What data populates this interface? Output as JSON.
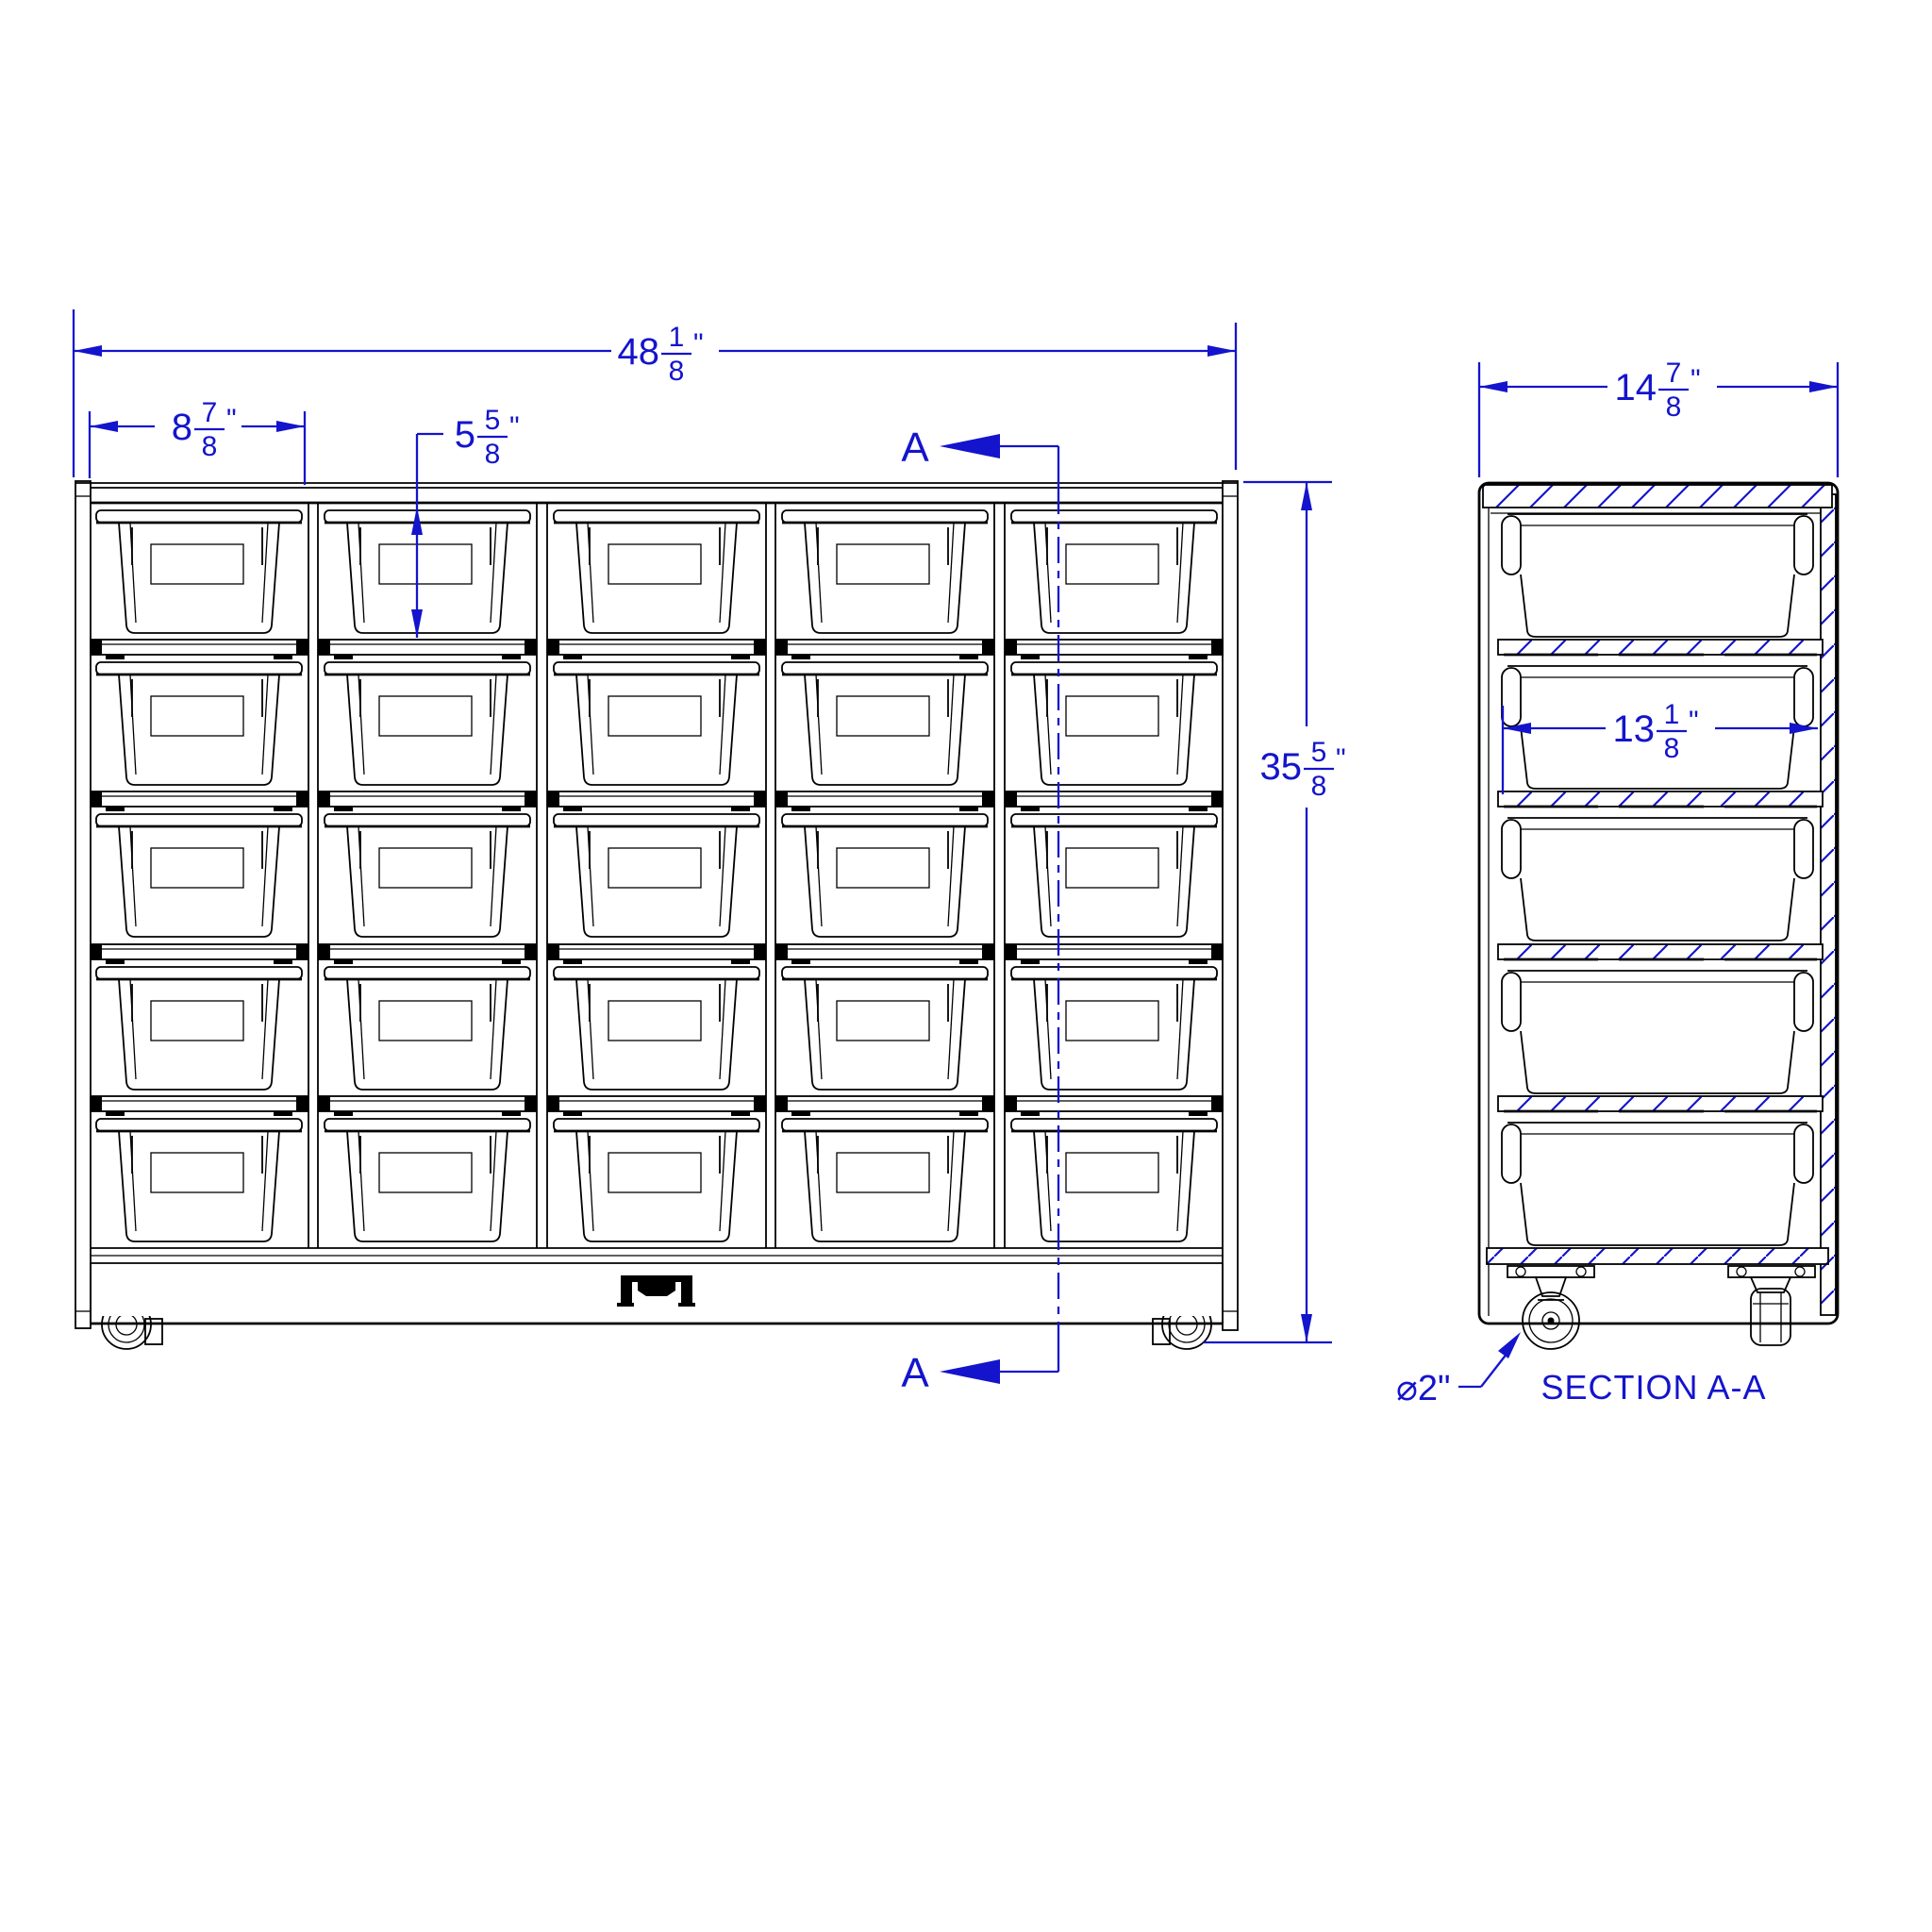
{
  "drawing_title": "mobile 25-tote storage unit drawing",
  "colors": {
    "dimension_blue": "#1414CC",
    "line_black": "#000000",
    "background": "#FFFFFF"
  },
  "front_view": {
    "dim_overall_width": {
      "whole": "48",
      "num": "1",
      "den": "8",
      "unit": "\""
    },
    "dim_cubby_width": {
      "whole": "8",
      "num": "7",
      "den": "8",
      "unit": "\""
    },
    "dim_opening_height": {
      "whole": "5",
      "num": "5",
      "den": "8",
      "unit": "\""
    },
    "dim_overall_height": {
      "whole": "35",
      "num": "5",
      "den": "8",
      "unit": "\""
    },
    "section_marker": "A"
  },
  "section_view": {
    "dim_depth": {
      "whole": "14",
      "num": "7",
      "den": "8",
      "unit": "\""
    },
    "dim_bin_width": {
      "whole": "13",
      "num": "1",
      "den": "8",
      "unit": "\""
    },
    "caster_diameter_label": "⌀2\"",
    "title": "SECTION A-A"
  }
}
